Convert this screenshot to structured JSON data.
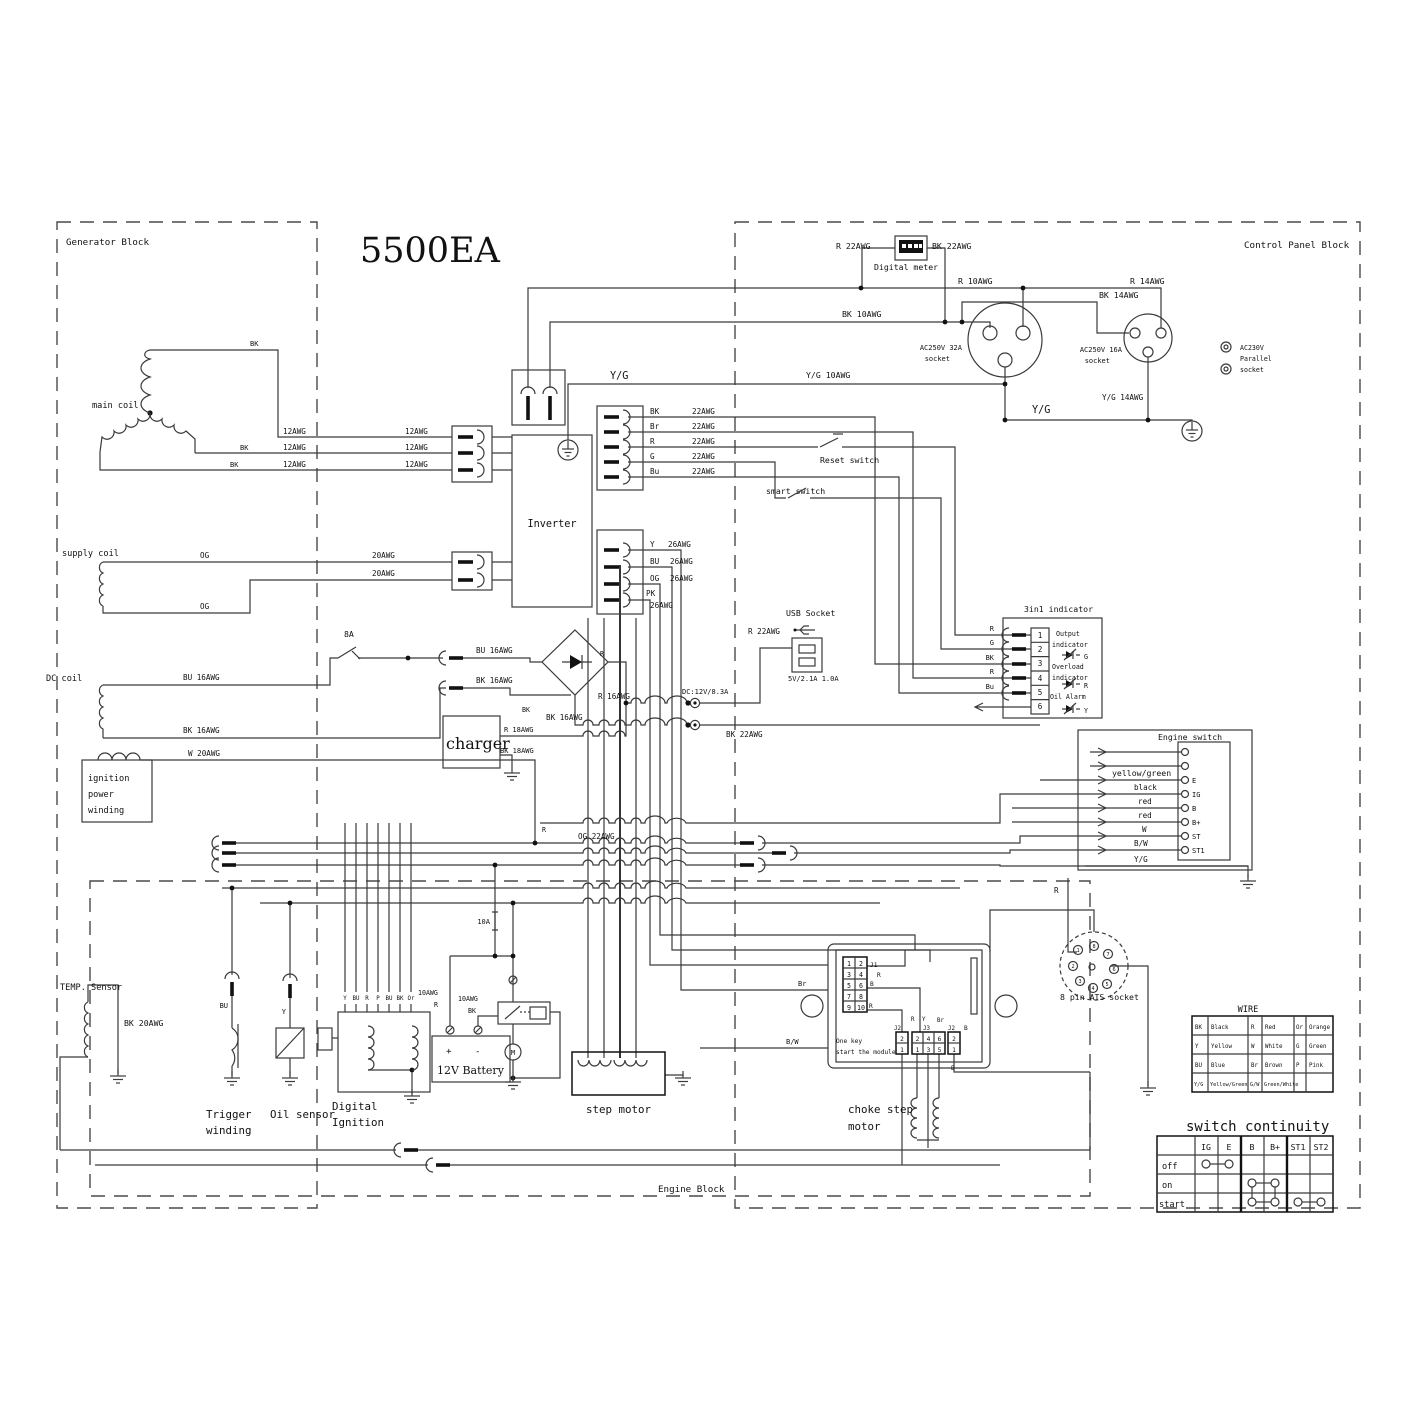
{
  "colors": {
    "line": "#3a3a3a",
    "ink": "#111111",
    "bg": "#ffffff"
  },
  "labels": {
    "title": "5500EA",
    "generator_block": "Generator Block",
    "control_block": "Control Panel Block",
    "engine_block": "Engine Block",
    "digital_meter": "Digital meter",
    "r22": "R 22AWG",
    "bk22": "BK 22AWG",
    "r10": "R 10AWG",
    "bk10": "BK 10AWG",
    "r14": "R 14AWG",
    "bk14": "BK 14AWG",
    "socket32_1": "AC250V 32A",
    "socket16_1": "AC250V 16A",
    "socket_word": "socket",
    "par1": "AC230V",
    "par2": "Parallel",
    "par3": "socket",
    "yg": "Y/G",
    "yg10": "Y/G 10AWG",
    "yg14": "Y/G 14AWG",
    "bk": "BK",
    "br": "Br",
    "r": "R",
    "g": "G",
    "bu": "Bu",
    "y": "Y",
    "bu_u": "BU",
    "og": "OG",
    "pk": "PK",
    "b": "B",
    "w": "W",
    "awg22": "22AWG",
    "awg26": "26AWG",
    "awg12": "12AWG",
    "awg20": "20AWG",
    "awg10": "10AWG",
    "reset_switch": "Reset switch",
    "smart_switch": "smart switch",
    "inverter": "Inverter",
    "usb_socket": "USB Socket",
    "usb_rating": "5V/2.1A 1.0A",
    "dc_rating": "DC:12V/8.3A",
    "fuse8a": "8A",
    "fuse10a": "10A",
    "bu16": "BU 16AWG",
    "bk16": "BK 16AWG",
    "r16": "R 16AWG",
    "charger": "charger",
    "r18": "R 18AWG",
    "bk18": "BK 18AWG",
    "supply_coil": "supply coil",
    "dc_coil": "DC coil",
    "main_coil": "main coil",
    "ign1": "ignition",
    "ign2": "power",
    "ign3": "winding",
    "w20": "W 20AWG",
    "og22": "OG 22AWG",
    "temp_sensor": "TEMP. Sensor",
    "bk20": "BK 20AWG",
    "trigger1": "Trigger",
    "trigger2": "winding",
    "oil_sensor": "Oil sensor",
    "digital1": "Digital",
    "digital2": "Ignition",
    "battery": "12V Battery",
    "plus": "+",
    "minus": "-",
    "motor_m": "M",
    "step_motor": "step motor",
    "choke1": "choke step",
    "choke2": "motor",
    "onekey1": "One key",
    "onekey2": "start the module",
    "j1": "J1",
    "j2": "J2",
    "j3": "J3",
    "bw": "B/W",
    "indicator_title": "3in1 indicator",
    "output_word": "Output",
    "indicator_word": "indicator",
    "overload_word": "Overload",
    "oil_alarm": "Oil Alarm",
    "engine_switch": "Engine switch",
    "es_e": "E",
    "es_ig": "IG",
    "es_b": "B",
    "es_bp": "B+",
    "es_st": "ST",
    "es_st1": "ST1",
    "wyg": "yellow/green",
    "wblack": "black",
    "wred": "red",
    "ats": "8 pin ATS socket"
  },
  "ign_pins": [
    "Y",
    "BU",
    "R",
    "P",
    "BU",
    "BK",
    "Or"
  ],
  "ind_pins": [
    "1",
    "2",
    "3",
    "4",
    "5",
    "6"
  ],
  "module_pins": [
    "1",
    "2",
    "3",
    "4",
    "5",
    "6",
    "7",
    "8",
    "9",
    "10"
  ],
  "j2_pins": [
    "2",
    "1"
  ],
  "j3_top": [
    "2",
    "4",
    "6"
  ],
  "j3_bot": [
    "1",
    "3",
    "5"
  ],
  "ats_pins": [
    "1",
    "2",
    "3",
    "4",
    "5",
    "6",
    "7",
    "8"
  ],
  "wire_table": {
    "title": "WIRE",
    "rows": [
      [
        "BK",
        "Black",
        "R",
        "Red",
        "Or",
        "Orange"
      ],
      [
        "Y",
        "Yellow",
        "W",
        "White",
        "G",
        "Green"
      ],
      [
        "BU",
        "Blue",
        "Br",
        "Brown",
        "P",
        "Pink"
      ],
      [
        "Y/G",
        "Yellow/Green",
        "G/W",
        "Green/White",
        "",
        ""
      ]
    ]
  },
  "continuity": {
    "title": "switch continuity",
    "cols": [
      "IG",
      "E",
      "B",
      "B+",
      "ST1",
      "ST2"
    ],
    "rows": [
      "off",
      "on",
      "start"
    ]
  }
}
